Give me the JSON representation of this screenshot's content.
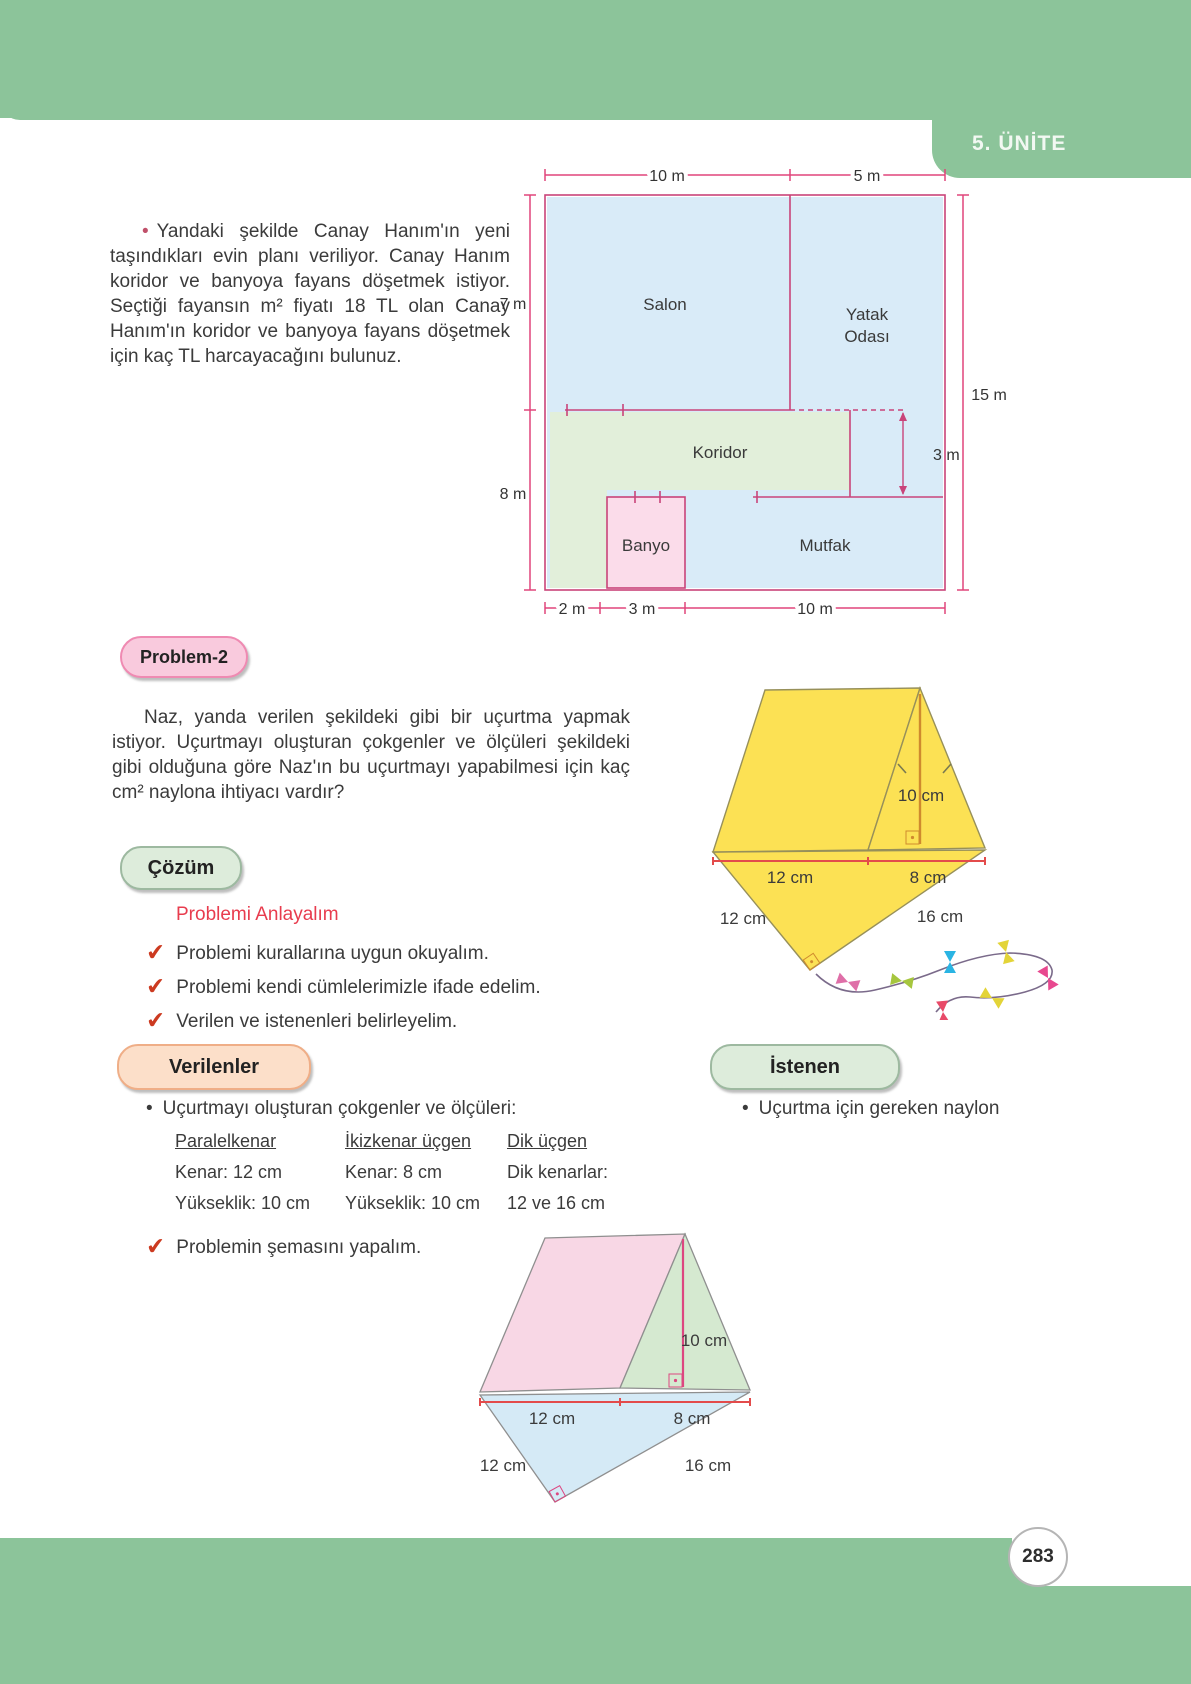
{
  "icons": {
    "bullet": "•",
    "check": "✔"
  },
  "header": {
    "unit_tab": "5. ÜNİTE"
  },
  "footer": {
    "page_number": "283"
  },
  "problem1": {
    "text": "Yandaki şekilde Canay Hanım'ın yeni taşındıkları evin planı veriliyor. Canay Hanım koridor ve banyoya fayans döşetmek istiyor. Seçtiği fayansın m² fiyatı 18 TL olan Canay Hanım'ın koridor ve banyoya fayans döşetmek için kaç TL harcayacağını bulunuz."
  },
  "floor_plan": {
    "rooms": {
      "salon": "Salon",
      "yatak_line1": "Yatak",
      "yatak_line2": "Odası",
      "koridor": "Koridor",
      "banyo": "Banyo",
      "mutfak": "Mutfak"
    },
    "dims": {
      "top_left": "10 m",
      "top_right": "5 m",
      "left_upper": "7 m",
      "left_lower": "8 m",
      "right": "15 m",
      "inner": "3 m",
      "bottom_1": "2 m",
      "bottom_2": "3 m",
      "bottom_3": "10 m"
    }
  },
  "problem2": {
    "badge": "Problem-2",
    "text": "Naz, yanda verilen şekildeki gibi bir uçurtma yapmak istiyor. Uçurtmayı oluşturan çokgenler ve ölçüleri şekildeki gibi olduğuna göre Naz'ın bu uçurtmayı yapabilmesi için kaç cm² naylona ihtiyacı vardır?"
  },
  "solution": {
    "badge": "Çözüm",
    "heading": "Problemi Anlayalım",
    "checklist": [
      "Problemi kurallarına uygun okuyalım.",
      "Problemi kendi cümlelerimizle ifade edelim.",
      "Verilen ve istenenleri belirleyelim."
    ],
    "schema_step": "Problemin şemasını yapalım."
  },
  "given": {
    "badge": "Verilenler",
    "intro": "Uçurtmayı oluşturan çokgenler ve ölçüleri:",
    "columns": [
      {
        "header": "Paralelkenar",
        "rows": [
          "Kenar: 12 cm",
          "Yükseklik: 10 cm"
        ]
      },
      {
        "header": "İkizkenar üçgen",
        "rows": [
          "Kenar: 8 cm",
          "Yükseklik: 10 cm"
        ]
      },
      {
        "header": "Dik üçgen",
        "rows": [
          "Dik kenarlar:",
          "12 ve 16 cm"
        ]
      }
    ]
  },
  "wanted": {
    "badge": "İstenen",
    "item": "Uçurtma için gereken naylon"
  },
  "kite_labels": {
    "height": "10 cm",
    "base_left": "12 cm",
    "base_right": "8 cm",
    "side_left": "12 cm",
    "side_right": "16 cm"
  },
  "colors": {
    "page_green": "#8cc49a",
    "dimension_pink": "#e0457b",
    "kite_yellow": "#fce154",
    "schema_pink": "#f8d7e5",
    "schema_green": "#d5e9d0",
    "schema_blue": "#d5eaf6",
    "check_red": "#cc3a20",
    "heading_red": "#e83c4e"
  }
}
